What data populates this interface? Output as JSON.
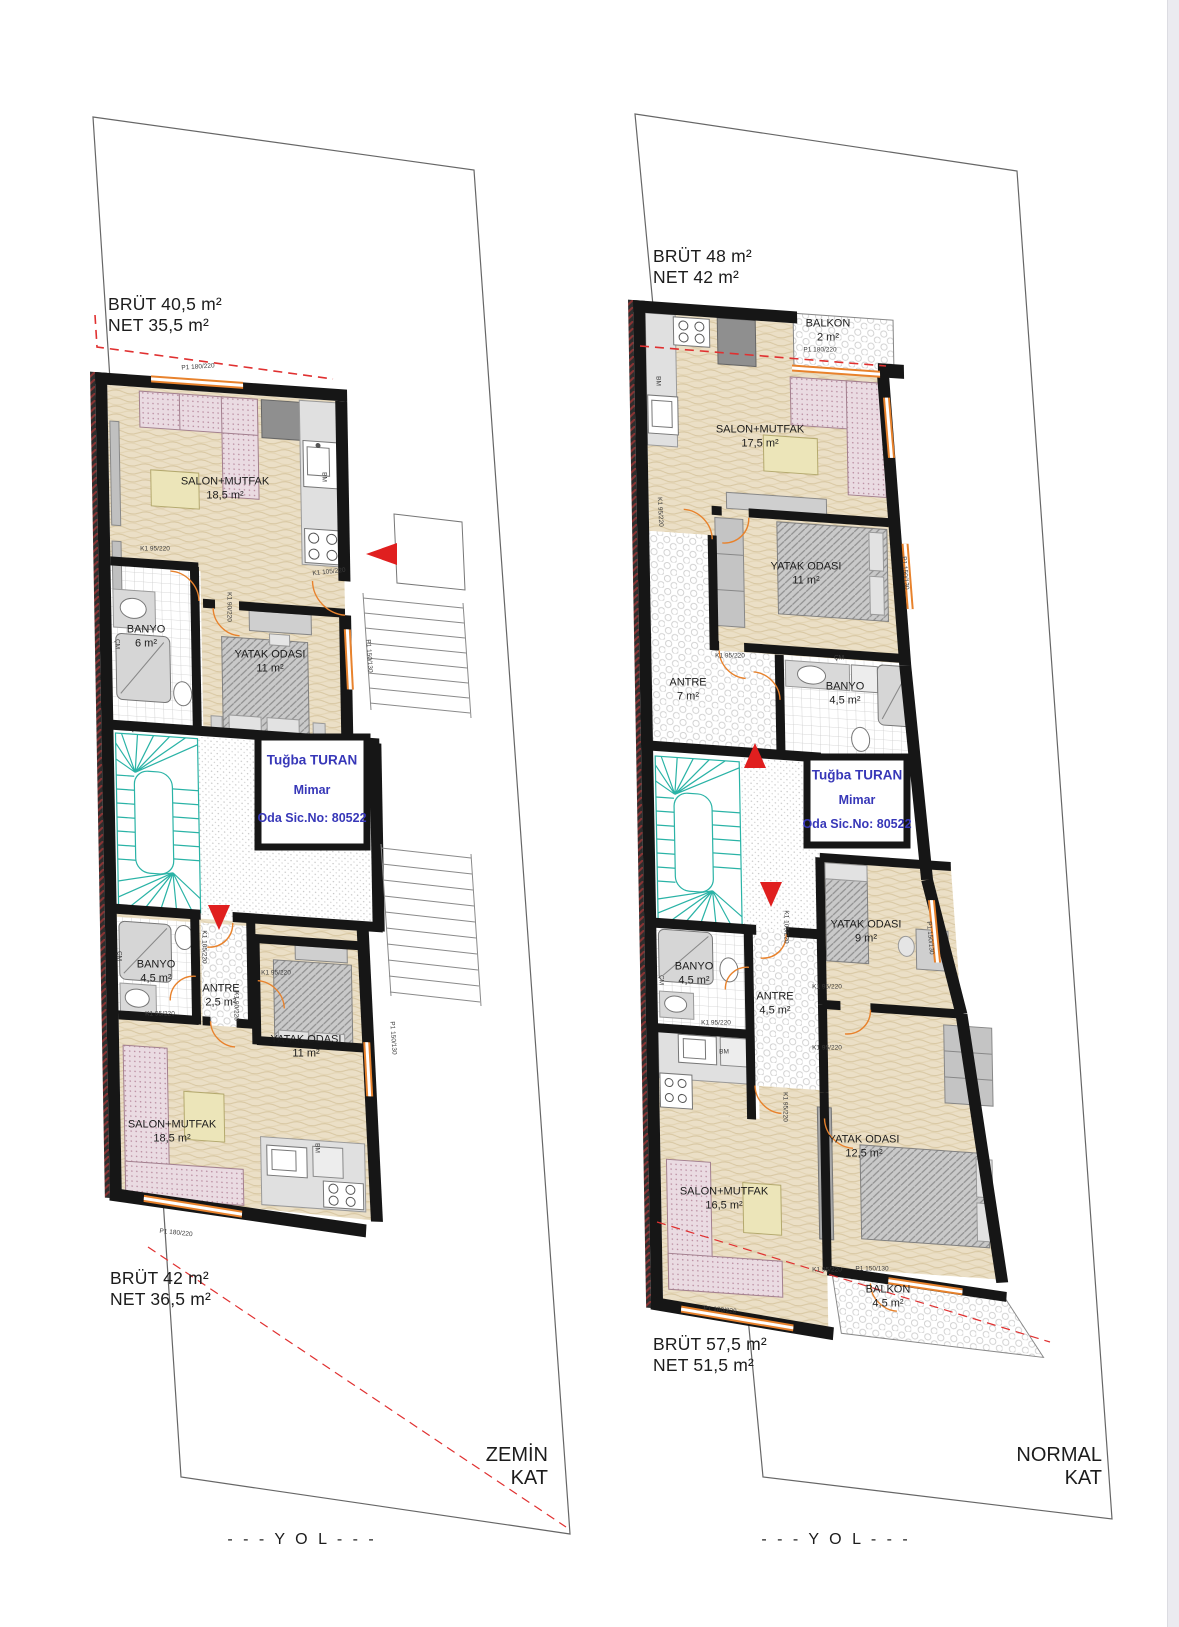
{
  "document": {
    "kind": "architectural floor plan drawing"
  },
  "colors": {
    "wall": "#161616",
    "window_orange": "#e8822c",
    "stair_teal": "#2ab3a6",
    "red_marker": "#e01f1f",
    "stamp_blue": "#3737b8",
    "parcel_line": "#666666"
  },
  "left_plan": {
    "floor_label": "ZEMİN\nKAT",
    "road_label": "- - - Y O L - - -",
    "area_top": "BRÜT 40,5 m²\nNET 35,5 m²",
    "area_bottom": "BRÜT 42 m²\nNET 36,5 m²",
    "rooms": [
      {
        "label": "SALON+MUTFAK\n18,5 m²"
      },
      {
        "label": "BANYO\n6 m²"
      },
      {
        "label": "YATAK ODASI\n11 m²"
      },
      {
        "label": "BANYO\n4,5 m²"
      },
      {
        "label": "ANTRE\n2,5 m²"
      },
      {
        "label": "YATAK ODASI\n11 m²"
      },
      {
        "label": "SALON+MUTFAK\n18,5 m²"
      }
    ],
    "stamp": {
      "name": "Tuğba TURAN",
      "title": "Mimar",
      "reg": "Oda Sic.No: 80522"
    },
    "tags": [
      {
        "t": "P1 180/220"
      },
      {
        "t": "K1 95/220"
      },
      {
        "t": "K1 105/220"
      },
      {
        "t": "K1 90/220"
      },
      {
        "t": "BM"
      },
      {
        "t": "ÇM"
      },
      {
        "t": "P1 150/130"
      },
      {
        "t": "K1 105/220"
      },
      {
        "t": "K1 95/220"
      },
      {
        "t": "K1 95/220"
      },
      {
        "t": "K1 90/220"
      },
      {
        "t": "BM"
      },
      {
        "t": "P1 180/220"
      },
      {
        "t": "P1 150/130"
      },
      {
        "t": "ÇM"
      }
    ]
  },
  "right_plan": {
    "floor_label": "NORMAL\nKAT",
    "road_label": "- - - Y O L - - -",
    "area_top": "BRÜT 48 m²\nNET 42 m²",
    "area_bottom": "BRÜT 57,5 m²\nNET 51,5 m²",
    "rooms": [
      {
        "label": "BALKON\n2 m²"
      },
      {
        "label": "SALON+MUTFAK\n17,5 m²"
      },
      {
        "label": "YATAK ODASI\n11 m²"
      },
      {
        "label": "ANTRE\n7 m²"
      },
      {
        "label": "BANYO\n4,5 m²"
      },
      {
        "label": "YATAK ODASI\n9 m²"
      },
      {
        "label": "BANYO\n4,5 m²"
      },
      {
        "label": "ANTRE\n4,5 m²"
      },
      {
        "label": "YATAK ODASI\n12,5 m²"
      },
      {
        "label": "SALON+MUTFAK\n16,5 m²"
      },
      {
        "label": "BALKON\n4,5 m²"
      }
    ],
    "stamp": {
      "name": "Tuğba TURAN",
      "title": "Mimar",
      "reg": "Oda Sic.No: 80522"
    },
    "tags": [
      {
        "t": "P1 180/220"
      },
      {
        "t": "BM"
      },
      {
        "t": "K1 95/220"
      },
      {
        "t": "P1 150/130"
      },
      {
        "t": "K1 95/220"
      },
      {
        "t": "ÇM"
      },
      {
        "t": "K1 95/220"
      },
      {
        "t": "K1 105/220"
      },
      {
        "t": "K1 95/220"
      },
      {
        "t": "K1 95/220"
      },
      {
        "t": "ÇM"
      },
      {
        "t": "BM"
      },
      {
        "t": "K1 95/220"
      },
      {
        "t": "K1 95/220"
      },
      {
        "t": "P1 150/130"
      },
      {
        "t": "P1 180/220"
      },
      {
        "t": "P1 150/130"
      }
    ]
  }
}
